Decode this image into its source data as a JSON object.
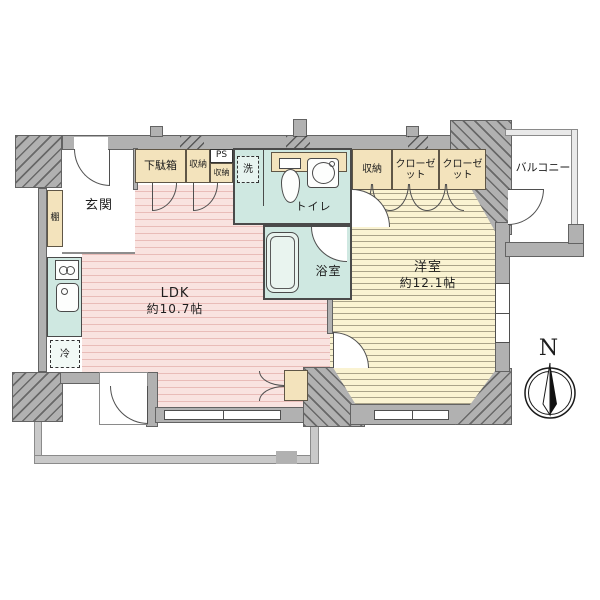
{
  "rooms": {
    "genkan": "玄関",
    "ldk_name": "LDK",
    "ldk_size": "約10.7帖",
    "western_name": "洋室",
    "western_size": "約12.1帖",
    "toilet": "トイレ",
    "bath": "浴室",
    "balcony": "バルコニー"
  },
  "fixtures": {
    "getabako": "下駄箱",
    "shuno_a": "収納",
    "ps": "PS",
    "shuno_b": "収納",
    "washer": "洗",
    "shelf": "棚",
    "fridge": "冷",
    "shuno_right": "収納",
    "closet_1": "クローゼット",
    "closet_2": "クローゼット"
  },
  "compass": {
    "north": "N"
  },
  "colors": {
    "wall": "#b1b1b1",
    "ldk_floor": "#f9e3e0",
    "ldk_stripe": "#e9bcb8",
    "western_floor": "#faf3d2",
    "western_stripe": "#aaa389",
    "wet_area": "#cfe8e1",
    "storage": "#f3e3bc",
    "line": "#4a4a4a"
  }
}
